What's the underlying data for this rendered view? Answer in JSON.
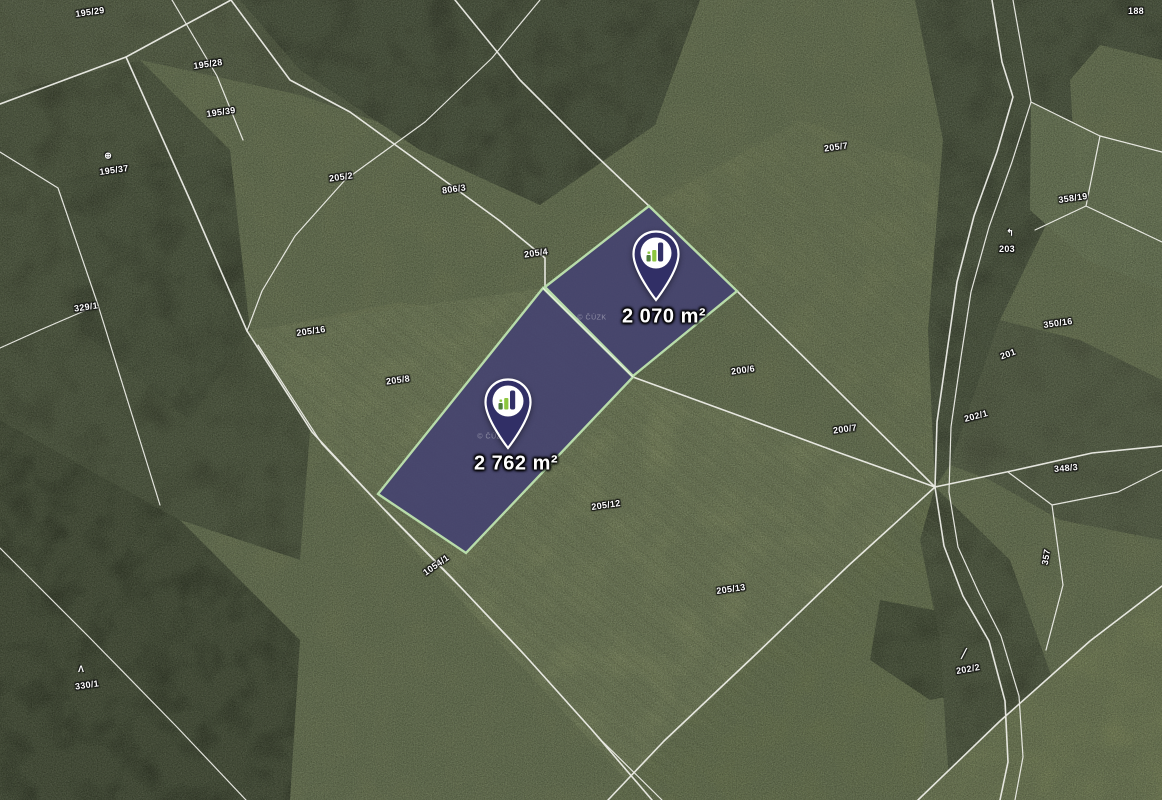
{
  "map": {
    "colors": {
      "parcel_fill": "#454370",
      "parcel_border": "#b8dcaa",
      "cadastral_line": "#f2f2ec",
      "pin_body": "#312f66",
      "pin_ring": "#ffffff",
      "pin_logo_green_light": "#8dc63f",
      "pin_logo_green_dark": "#4e7e3a",
      "label_text": "#ffffff"
    },
    "area_labels": [
      {
        "text": "2 070 m²",
        "x": 664,
        "y": 317,
        "rot": 0
      },
      {
        "text": "2 762 m²",
        "x": 516,
        "y": 464,
        "rot": 0
      }
    ],
    "pins": [
      {
        "name": "pin-parcel-2070",
        "x": 632,
        "y": 230
      },
      {
        "name": "pin-parcel-2762",
        "x": 484,
        "y": 378
      }
    ],
    "parcel_labels": [
      {
        "text": "195/29",
        "x": 90,
        "y": 12,
        "rot": -8
      },
      {
        "text": "195/28",
        "x": 208,
        "y": 64,
        "rot": -8
      },
      {
        "text": "195/39",
        "x": 221,
        "y": 112,
        "rot": -8
      },
      {
        "text": "195/37",
        "x": 114,
        "y": 170,
        "rot": -8
      },
      {
        "text": "329/1",
        "x": 86,
        "y": 307,
        "rot": -8
      },
      {
        "text": "205/2",
        "x": 341,
        "y": 177,
        "rot": -8
      },
      {
        "text": "806/3",
        "x": 454,
        "y": 189,
        "rot": -8
      },
      {
        "text": "205/4",
        "x": 536,
        "y": 253,
        "rot": -8
      },
      {
        "text": "205/7",
        "x": 836,
        "y": 147,
        "rot": -8
      },
      {
        "text": "205/16",
        "x": 311,
        "y": 331,
        "rot": -8
      },
      {
        "text": "205/8",
        "x": 398,
        "y": 380,
        "rot": -8
      },
      {
        "text": "200/6",
        "x": 743,
        "y": 370,
        "rot": -8
      },
      {
        "text": "200/7",
        "x": 845,
        "y": 429,
        "rot": -8
      },
      {
        "text": "205/12",
        "x": 606,
        "y": 505,
        "rot": -8
      },
      {
        "text": "205/13",
        "x": 731,
        "y": 589,
        "rot": -8
      },
      {
        "text": "1054/1",
        "x": 436,
        "y": 565,
        "rot": -35
      },
      {
        "text": "330/1",
        "x": 87,
        "y": 685,
        "rot": -8
      },
      {
        "text": "358/19",
        "x": 1073,
        "y": 198,
        "rot": -8
      },
      {
        "text": "203",
        "x": 1007,
        "y": 249,
        "rot": 0
      },
      {
        "text": "350/16",
        "x": 1058,
        "y": 323,
        "rot": -8
      },
      {
        "text": "201",
        "x": 1008,
        "y": 354,
        "rot": -20
      },
      {
        "text": "202/1",
        "x": 976,
        "y": 416,
        "rot": -15
      },
      {
        "text": "348/3",
        "x": 1066,
        "y": 468,
        "rot": -5
      },
      {
        "text": "357",
        "x": 1046,
        "y": 557,
        "rot": -80
      },
      {
        "text": "202/2",
        "x": 968,
        "y": 669,
        "rot": -10
      },
      {
        "text": "188",
        "x": 1136,
        "y": 11,
        "rot": 0
      }
    ],
    "symbols": [
      {
        "glyph": "⊕",
        "x": 108,
        "y": 156,
        "rot": 0
      },
      {
        "glyph": "Λ",
        "x": 81,
        "y": 669,
        "rot": 0
      },
      {
        "glyph": "↰",
        "x": 1010,
        "y": 233,
        "rot": 0
      },
      {
        "glyph": "╱",
        "x": 964,
        "y": 654,
        "rot": 0
      }
    ],
    "watermarks": [
      {
        "text": "© ČÚZK",
        "x": 592,
        "y": 318
      },
      {
        "text": "© ČÚZK",
        "x": 492,
        "y": 437
      }
    ]
  }
}
